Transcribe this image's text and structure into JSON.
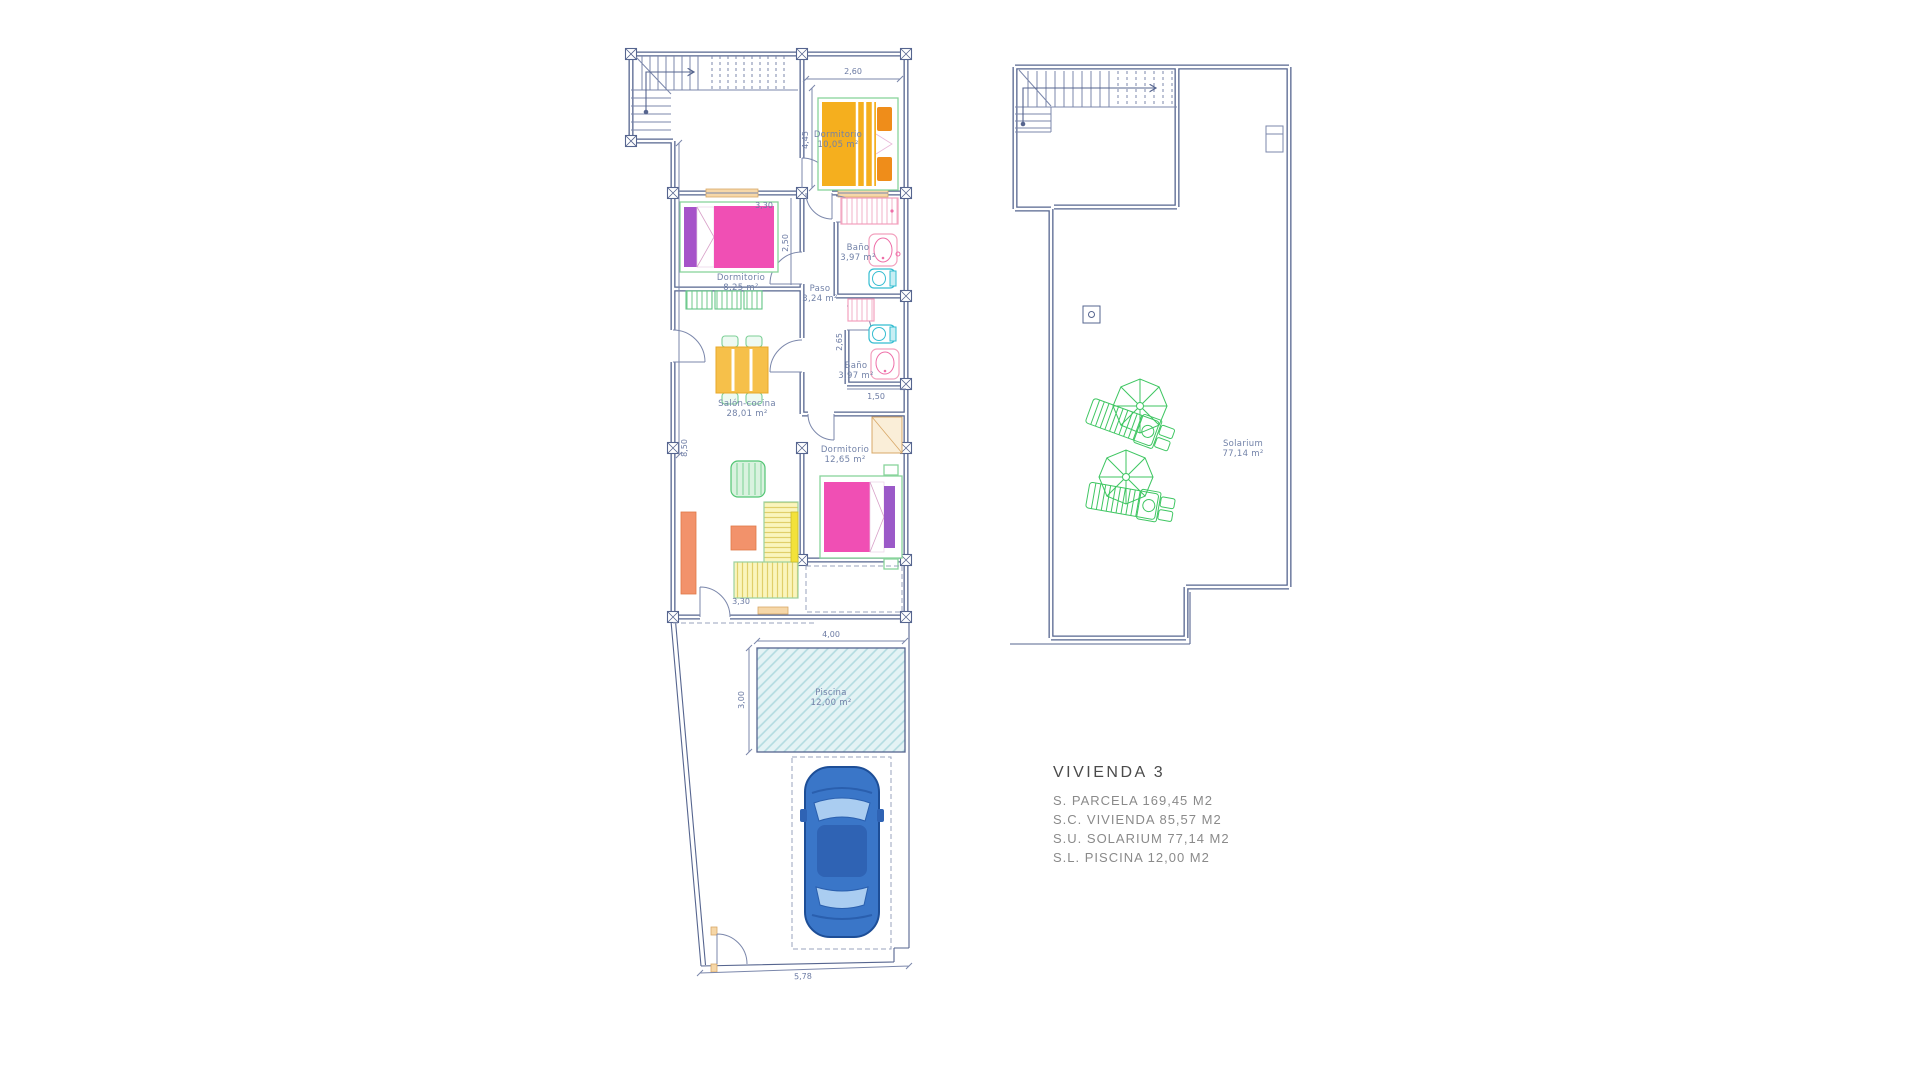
{
  "plan": {
    "ground": {
      "rooms": {
        "dorm1": {
          "name": "Dormitorio",
          "area": "10,05 m²"
        },
        "bath1": {
          "name": "Baño",
          "area": "3,97 m²"
        },
        "paso": {
          "name": "Paso",
          "area": "3,24 m²"
        },
        "bath2": {
          "name": "Baño",
          "area": "3,97 m²"
        },
        "dorm2": {
          "name": "Dormitorio",
          "area": "8,25 m²"
        },
        "salon": {
          "name": "Salón-cocina",
          "area": "28,01 m²"
        },
        "dorm3": {
          "name": "Dormitorio",
          "area": "12,65 m²"
        },
        "pool": {
          "name": "Piscina",
          "area": "12,00 m²"
        }
      },
      "dims": {
        "bed1_w": "2,60",
        "bed1_h": "4,45",
        "bed2_w": "3,30",
        "bed2_h": "2,50",
        "hall_h": "2,65",
        "bath2_w": "1,50",
        "salon_h": "8,50",
        "salon_door": "3,30",
        "pool_w": "4,00",
        "pool_h": "3,00",
        "plot_w": "5,78"
      }
    },
    "roof": {
      "solarium": {
        "name": "Solarium",
        "area": "77,14 m²"
      }
    }
  },
  "legend": {
    "title": "VIVIENDA 3",
    "rows": [
      "S. PARCELA 169,45 M2",
      "S.C. VIVIENDA 85,57 M2",
      "S.U. SOLARIUM 77,14 M2",
      "S.L. PISCINA 12,00 M2"
    ]
  },
  "colors": {
    "wall": "#56658f",
    "dim_text": "#6b7aa3",
    "bed_pink": "#f04fb4",
    "headboard_purple": "#a653c9",
    "bed_yellow": "#f5af1e",
    "pillow_orange": "#ef8d1a",
    "furniture_green": "#88d49c",
    "solarium_green": "#3fc662",
    "salmon": "#f2926b",
    "sofa_yellow": "#faf5bd",
    "pool_fill": "#e4f3f5",
    "car_blue": "#3a76c8",
    "toilet_cyan": "#35bdd1",
    "window_tan": "#f6d7a8",
    "legend_text": "#8a8a8a",
    "legend_title": "#4a4a4a"
  }
}
